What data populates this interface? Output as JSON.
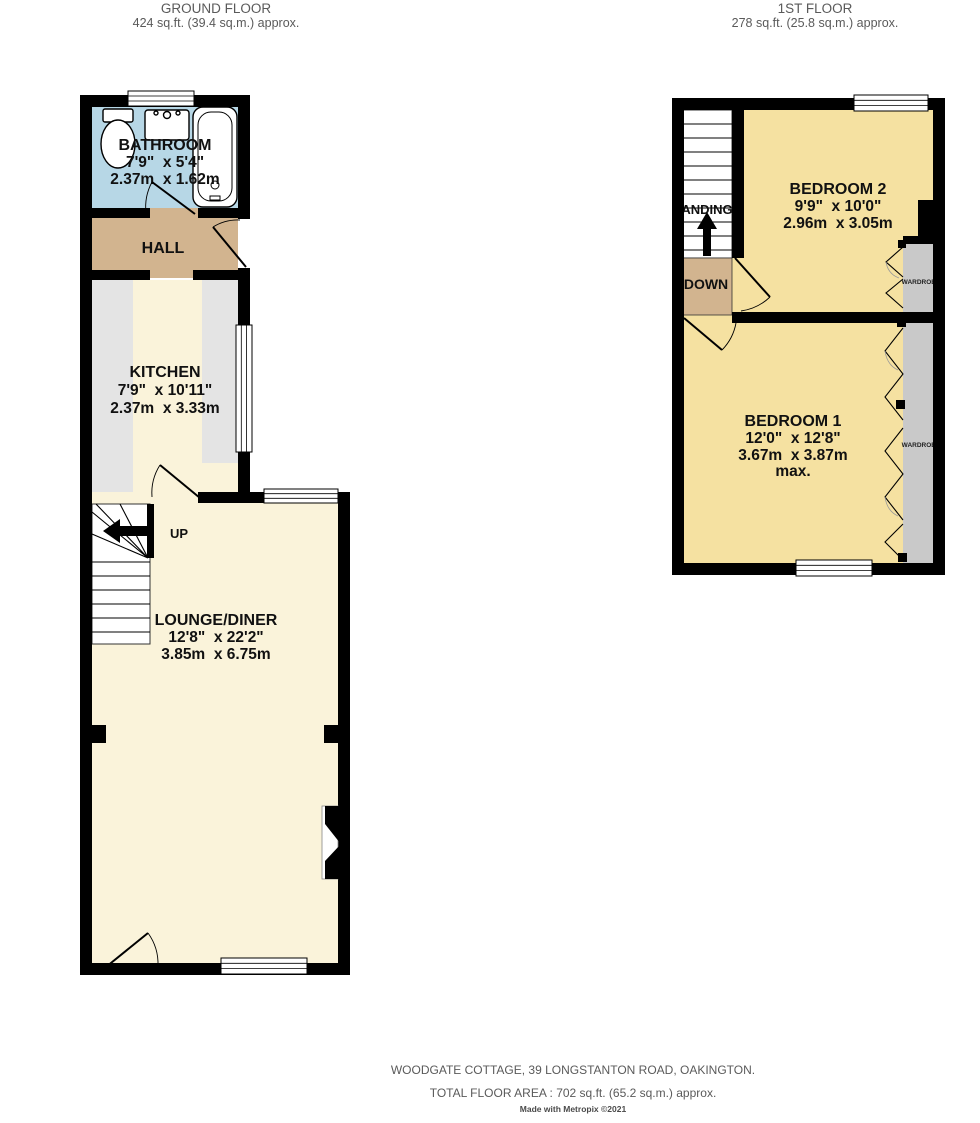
{
  "colors": {
    "wall": "#000000",
    "bathroom": "#b7d7e6",
    "hall": "#d2b48f",
    "cream": "#faf3da",
    "bedroom": "#f5e1a1",
    "counter": "#e4e4e4",
    "wardrobe": "#c9c9c9",
    "landing": "#d2b48f"
  },
  "ground_floor": {
    "title": "GROUND FLOOR",
    "area": "424 sq.ft. (39.4 sq.m.) approx.",
    "bathroom": {
      "name": "BATHROOM",
      "imperial": "7'9\"  x 5'4\"",
      "metric": "2.37m  x 1.62m"
    },
    "hall": {
      "name": "HALL"
    },
    "kitchen": {
      "name": "KITCHEN",
      "imperial": "7'9\"  x 10'11\"",
      "metric": "2.37m  x 3.33m"
    },
    "lounge": {
      "name": "LOUNGE/DINER",
      "imperial": "12'8\"  x 22'2\"",
      "metric": "3.85m  x 6.75m"
    },
    "up": "UP"
  },
  "first_floor": {
    "title": "1ST FLOOR",
    "area": "278 sq.ft. (25.8 sq.m.) approx.",
    "bedroom2": {
      "name": "BEDROOM 2",
      "imperial": "9'9\"  x 10'0\"",
      "metric": "2.96m  x 3.05m"
    },
    "bedroom1": {
      "name": "BEDROOM 1",
      "imperial": "12'0\"  x 12'8\"",
      "metric": "3.67m  x 3.87m",
      "max": "max."
    },
    "landing": "LANDING",
    "down": "DOWN",
    "wardrobe": "WARDROBE"
  },
  "footer": {
    "address": "WOODGATE COTTAGE, 39 LONGSTANTON ROAD, OAKINGTON.",
    "total_area": "TOTAL FLOOR AREA : 702 sq.ft. (65.2 sq.m.) approx.",
    "credit": "Made with Metropix ©2021"
  }
}
